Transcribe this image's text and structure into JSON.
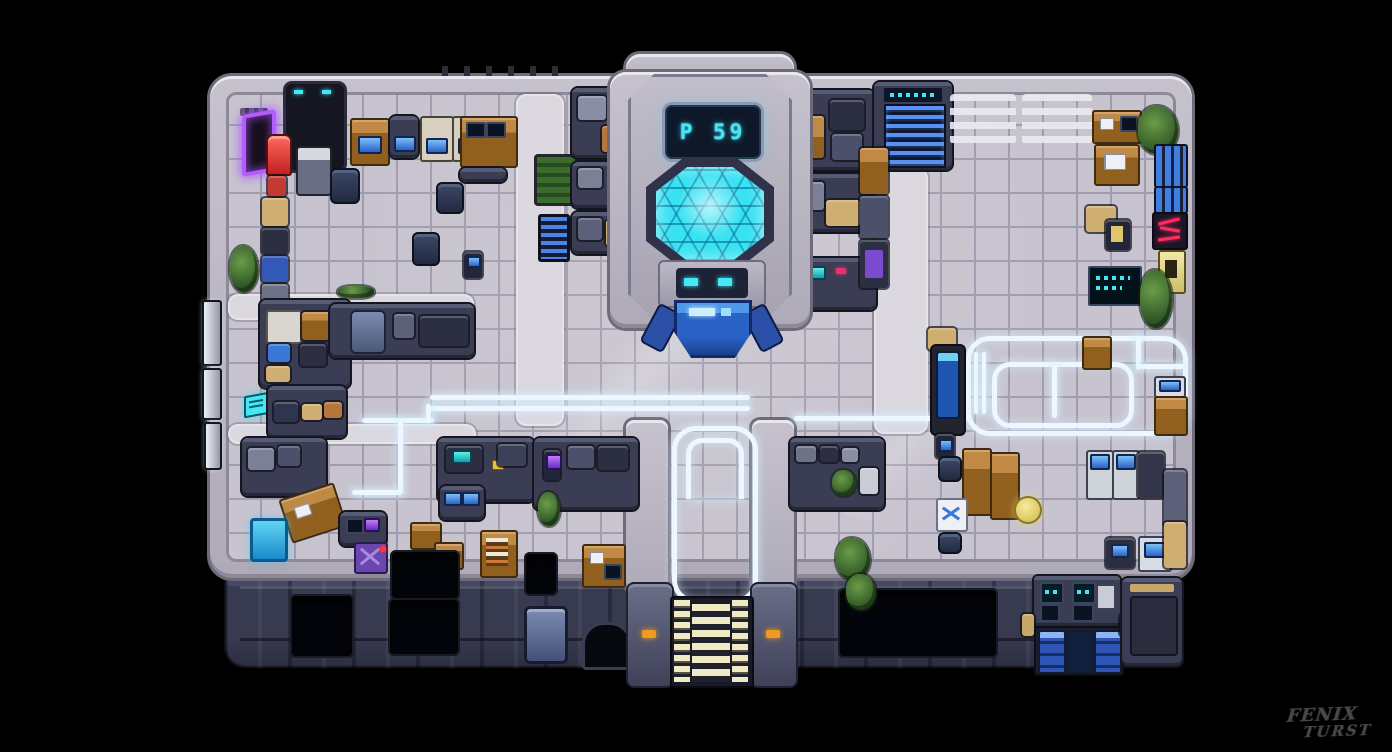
{
  "scene": {
    "type": "pixel-art top-down sci-fi station map",
    "watermark": {
      "line1": "FENIX",
      "line2": "TURST"
    },
    "features": [
      "reactor-chamber",
      "numeric-display",
      "airlock-door",
      "entrance-stairs",
      "upper-floor-staircase",
      "holo-floor-track",
      "locker-bank",
      "vending-machine",
      "neon-doorway",
      "cafeteria-tables",
      "server-consoles",
      "planters"
    ]
  },
  "hud": {
    "chamber_display": "P 59"
  },
  "colors": {
    "bg": "#000000",
    "wall": "#b7b3c0",
    "wall-edge": "#77727f",
    "room": "#3a3d54",
    "room-hi": "#565b76",
    "outline": "#14151e",
    "floor": "#c8c4cf",
    "floor-line": "#a29cb0",
    "walkway": "#dbd8e0",
    "glow": "#eef7ff",
    "cyan": "#43e8f4",
    "cyan-deep": "#149ec4",
    "display-bg": "#0e1828",
    "neon-purple": "#b45cff",
    "vending-red": "#d8332f",
    "wood": "#91601f",
    "wood-light": "#c08a45",
    "blue": "#2f5fc4",
    "blue-bright": "#5a9af0",
    "stair-cream": "#efe9c4",
    "steel": "#6d7ea6",
    "orange": "#f09a22",
    "green": "#3f6f35",
    "yellow": "#ecd76e",
    "magenta": "#e8316e",
    "purple": "#6a46b0",
    "facade": "#383b50",
    "signature": "#474747"
  }
}
